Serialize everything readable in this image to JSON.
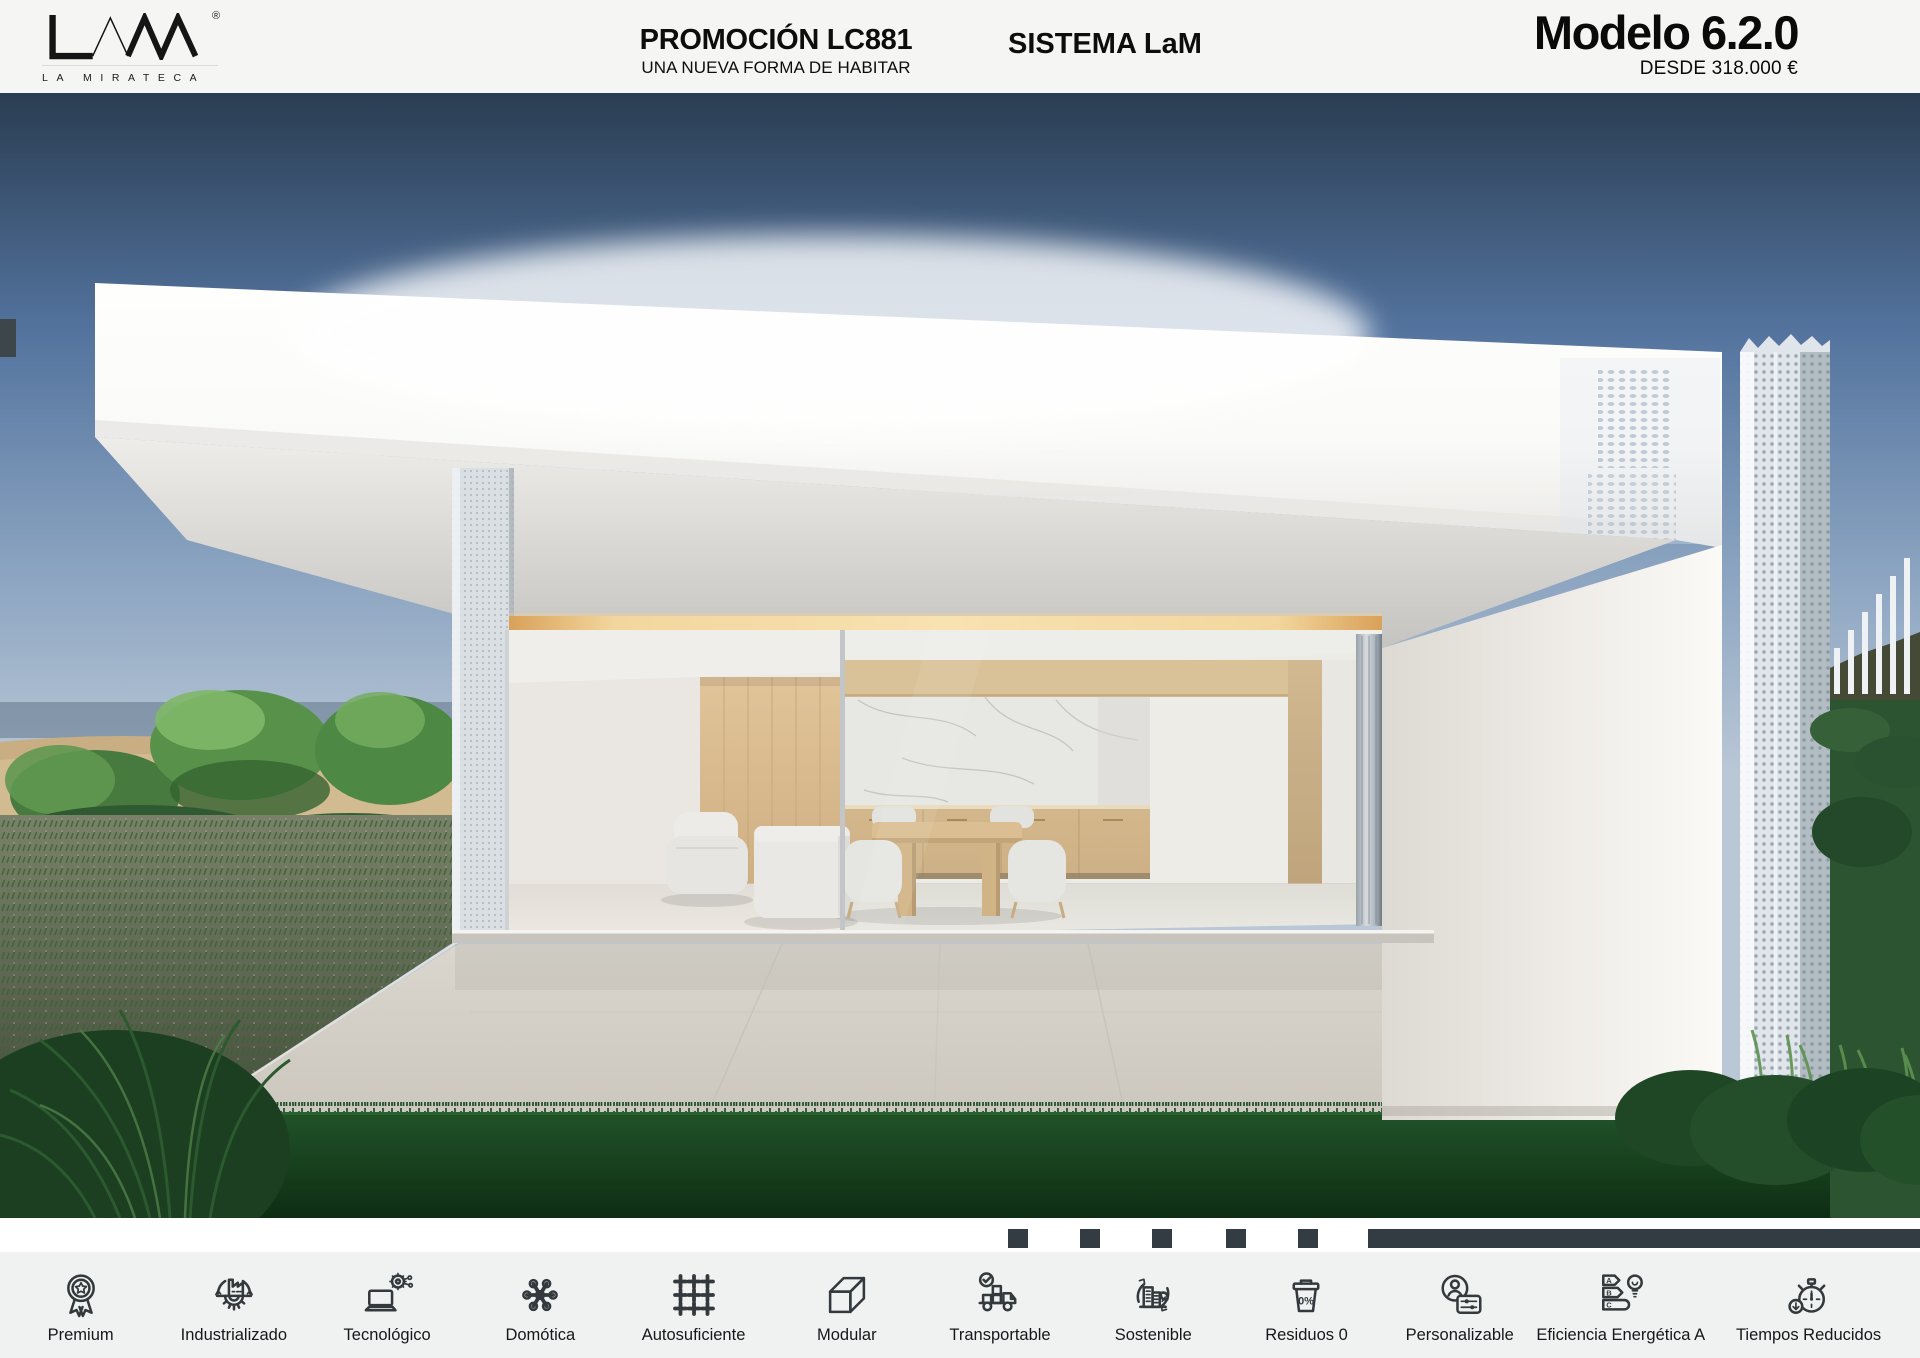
{
  "header": {
    "logo": {
      "brand": "LAM",
      "registered": "®",
      "tagline": "LA MIRATECA"
    },
    "promotion": {
      "title": "PROMOCIÓN LC881",
      "subtitle": "UNA NUEVA FORMA DE HABITAR"
    },
    "system": {
      "title": "SISTEMA LaM"
    },
    "model": {
      "name": "Modelo 6.2.0",
      "price": "DESDE 318.000 €"
    }
  },
  "hero": {
    "description": "Render exterior de vivienda modular blanca de cubierta plana con salón abierto (butaca, sofá, mesa de comedor, cocina de madera y pared de mármol), terraza de hormigón claro, césped, vegetación mediterránea a la izquierda y pilar perforado con valla blanca a la derecha bajo cielo azul degradado.",
    "palette": {
      "sky_top": "#2a3d52",
      "sky_horizon": "#b9c7d6",
      "structure_white": "#f7f6f3",
      "soffit_gray": "#c5c3bf",
      "led_accent": "#f2d69d",
      "wood": "#d9b98c",
      "marble": "#ebe9e4",
      "patio": "#d5d1c8",
      "grass_dark": "#1b4a22",
      "foliage": "#4e8646",
      "dune_sand": "#c9ae84"
    }
  },
  "carousel": {
    "inactive_squares": 5,
    "active_segment": 1,
    "indicator_color": "#333c42"
  },
  "features": {
    "items": [
      {
        "icon": "award-rosette-icon",
        "label": "Premium"
      },
      {
        "icon": "factory-gear-icon",
        "label": "Industrializado"
      },
      {
        "icon": "laptop-network-icon",
        "label": "Tecnológico"
      },
      {
        "icon": "smart-hub-icon",
        "label": "Domótica"
      },
      {
        "icon": "plus-grid-icon",
        "label": "Autosuficiente"
      },
      {
        "icon": "module-block-icon",
        "label": "Modular"
      },
      {
        "icon": "truck-check-icon",
        "label": "Transportable"
      },
      {
        "icon": "eco-building-icon",
        "label": "Sostenible"
      },
      {
        "icon": "zero-waste-bin-icon",
        "label": "Residuos 0",
        "icon_text": "0%"
      },
      {
        "icon": "user-sliders-icon",
        "label": "Personalizable"
      },
      {
        "icon": "energy-rating-icon",
        "label": "Eficiencia Energética A",
        "letters": [
          "A",
          "B",
          "C"
        ]
      },
      {
        "icon": "stopwatch-icon",
        "label": "Tiempos Reducidos"
      }
    ]
  },
  "colors": {
    "header_bg": "#f5f5f4",
    "strip_bg": "#ffffff",
    "features_bg": "#f0f2f1",
    "icon": "#33393c",
    "text": "#121416"
  }
}
